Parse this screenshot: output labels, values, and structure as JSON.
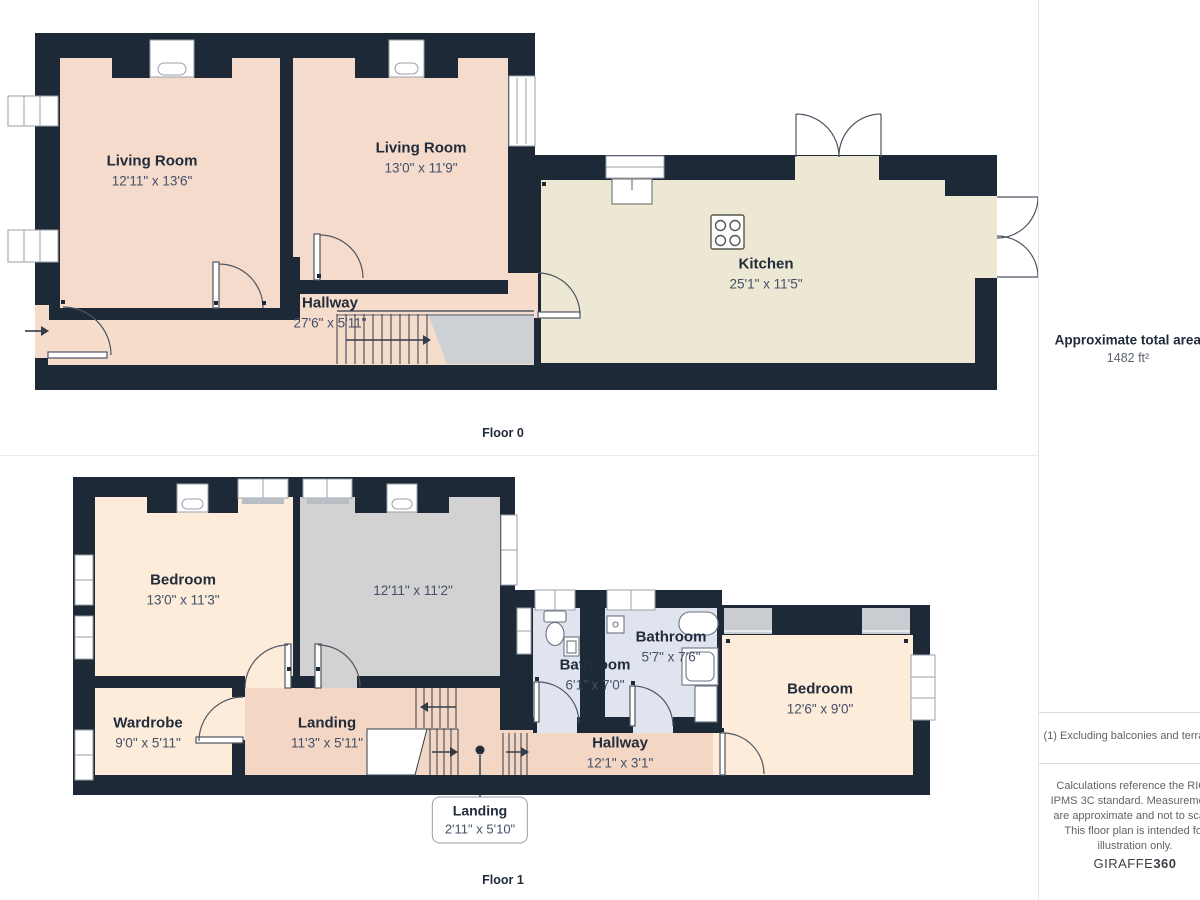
{
  "floor0": {
    "caption": "Floor 0",
    "rooms": [
      {
        "name": "Living Room",
        "dims": "12'11\" x 13'6\""
      },
      {
        "name": "Living Room",
        "dims": "13'0\" x 11'9\""
      },
      {
        "name": "Hallway",
        "dims": "27'6\" x 5'11\""
      },
      {
        "name": "Kitchen",
        "dims": "25'1\" x 11'5\""
      }
    ]
  },
  "floor1": {
    "caption": "Floor 1",
    "rooms": [
      {
        "name": "Bedroom",
        "dims": "13'0\" x 11'3\""
      },
      {
        "name": "",
        "dims": "12'11\" x 11'2\""
      },
      {
        "name": "Wardrobe",
        "dims": "9'0\" x 5'11\""
      },
      {
        "name": "Landing",
        "dims": "11'3\" x 5'11\""
      },
      {
        "name": "Bathroom",
        "dims": "6'1\" x 7'0\""
      },
      {
        "name": "Bathroom",
        "dims": "5'7\" x 7'6\""
      },
      {
        "name": "Hallway",
        "dims": "12'1\" x 3'1\""
      },
      {
        "name": "Bedroom",
        "dims": "12'6\" x 9'0\""
      }
    ],
    "callout": {
      "name": "Landing",
      "dims": "2'11\" x 5'10\""
    }
  },
  "sidebar": {
    "area_title": "Approximate total area",
    "area_sup": "(1)",
    "area_value": "1482 ft²",
    "footnote": "(1) Excluding balconies and terraces",
    "disclaimer": "Calculations reference the RICS IPMS 3C standard. Measurements are approximate and not to scale. This floor plan is intended for illustration only.",
    "brand_regular": "GIRAFFE",
    "brand_bold": "360"
  },
  "colors": {
    "wall": "#1e2937",
    "room_peach": "#f4dbcc",
    "hallway_salmon": "#f3d6c4",
    "kitchen_cream": "#ece8d3",
    "bedroom_cream": "#fcecd9",
    "gray_room": "#d2d2d2",
    "bathroom_blue": "#e0e4ee",
    "stair_gray": "#cdd1d5"
  }
}
